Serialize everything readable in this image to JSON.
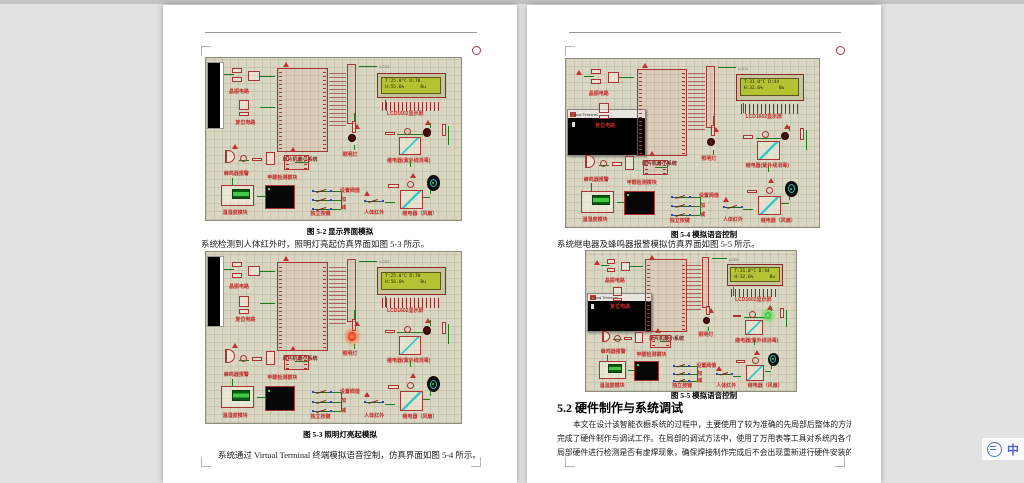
{
  "app": {
    "canvas_background": "#e2e2e2",
    "top_strip_color": "#c3c3c3"
  },
  "left_page": {
    "caption_52": "图 5-2 显示界面模拟",
    "para_after_52": "系统检测到人体红外时，照明灯亮起仿真界面如图 5-3 所示。",
    "caption_53": "图 5-3 照明灯亮起模拟",
    "para_after_53": "系统通过 Virtual Terminal 终端模拟语音控制，仿真界面如图 5-4 所示。"
  },
  "right_page": {
    "caption_54": "图 5-4 模拟语音控制",
    "para_after_54": "系统继电器及蜂鸣器报警模拟仿真界面如图 5-5 所示。",
    "caption_55": "图 5-5 模拟语音控制",
    "heading": "5.2 硬件制作与系统调试",
    "body_lines": [
      "本文在设计该智能衣橱系统的过程中，主要使用了较为准确的先局部后整体的方法",
      "完成了硬件制作与调试工作。在局部的调试方法中，使用了万用表等工具对系统内各个",
      "局部硬件进行检测是否有虚焊现象，确保焊接制作完成后不会出现重新进行硬件安装的"
    ]
  },
  "ime": {
    "mode_text": "中"
  },
  "schematic": {
    "colors": {
      "board": "#d9d6c2",
      "component_outline": "#a83434",
      "label_red": "#c22a2a",
      "wire_green": "#1d7a1d",
      "lcd_screen": "#b5c234",
      "led_off": "#4a0d0d",
      "led_on_red": "#e03020",
      "led_on_green": "#2dbb2d",
      "relay_switch": "#39c8c8"
    },
    "labels": {
      "crystal": "晶振电路",
      "reset": "复位电路",
      "mcu": "单片机最小系统",
      "lcd_ref": "LCD1",
      "lcd": "LCD1602显示屏",
      "lamp": "照明灯",
      "relay_uv": "继电器(紫外线消毒)",
      "buzzer": "蜂鸣器报警",
      "ch2o": "甲醛检测模块",
      "dht": "温湿度模块",
      "keys": "独立按键",
      "key_hints": [
        "设置阀值",
        "加",
        "减"
      ],
      "pir": "人体红外",
      "relay_fan": "继电器（风扇）",
      "terminal_title": "Virtual Terminal"
    },
    "diagrams": [
      {
        "figure": "5-2",
        "lcd_line1": "T:25.0°C D:70",
        "lcd_line2": "H:55.6%      Bu",
        "lamp": "off",
        "uv": "off",
        "terminal": "strip"
      },
      {
        "figure": "5-3",
        "lcd_line1": "T:25.0°C D:70",
        "lcd_line2": "H:56.6%      Bu",
        "lamp": "on",
        "uv": "off",
        "terminal": "strip"
      },
      {
        "figure": "5-4",
        "lcd_line1": "T:31.0°C D:44",
        "lcd_line2": "H:32.6%      Bu",
        "lamp": "off",
        "uv": "off",
        "terminal": "window"
      },
      {
        "figure": "5-5",
        "lcd_line1": "T:31.0°C D:44",
        "lcd_line2": "H:32.6%      Bu",
        "lamp": "off",
        "uv": "on",
        "terminal": "window"
      }
    ]
  }
}
